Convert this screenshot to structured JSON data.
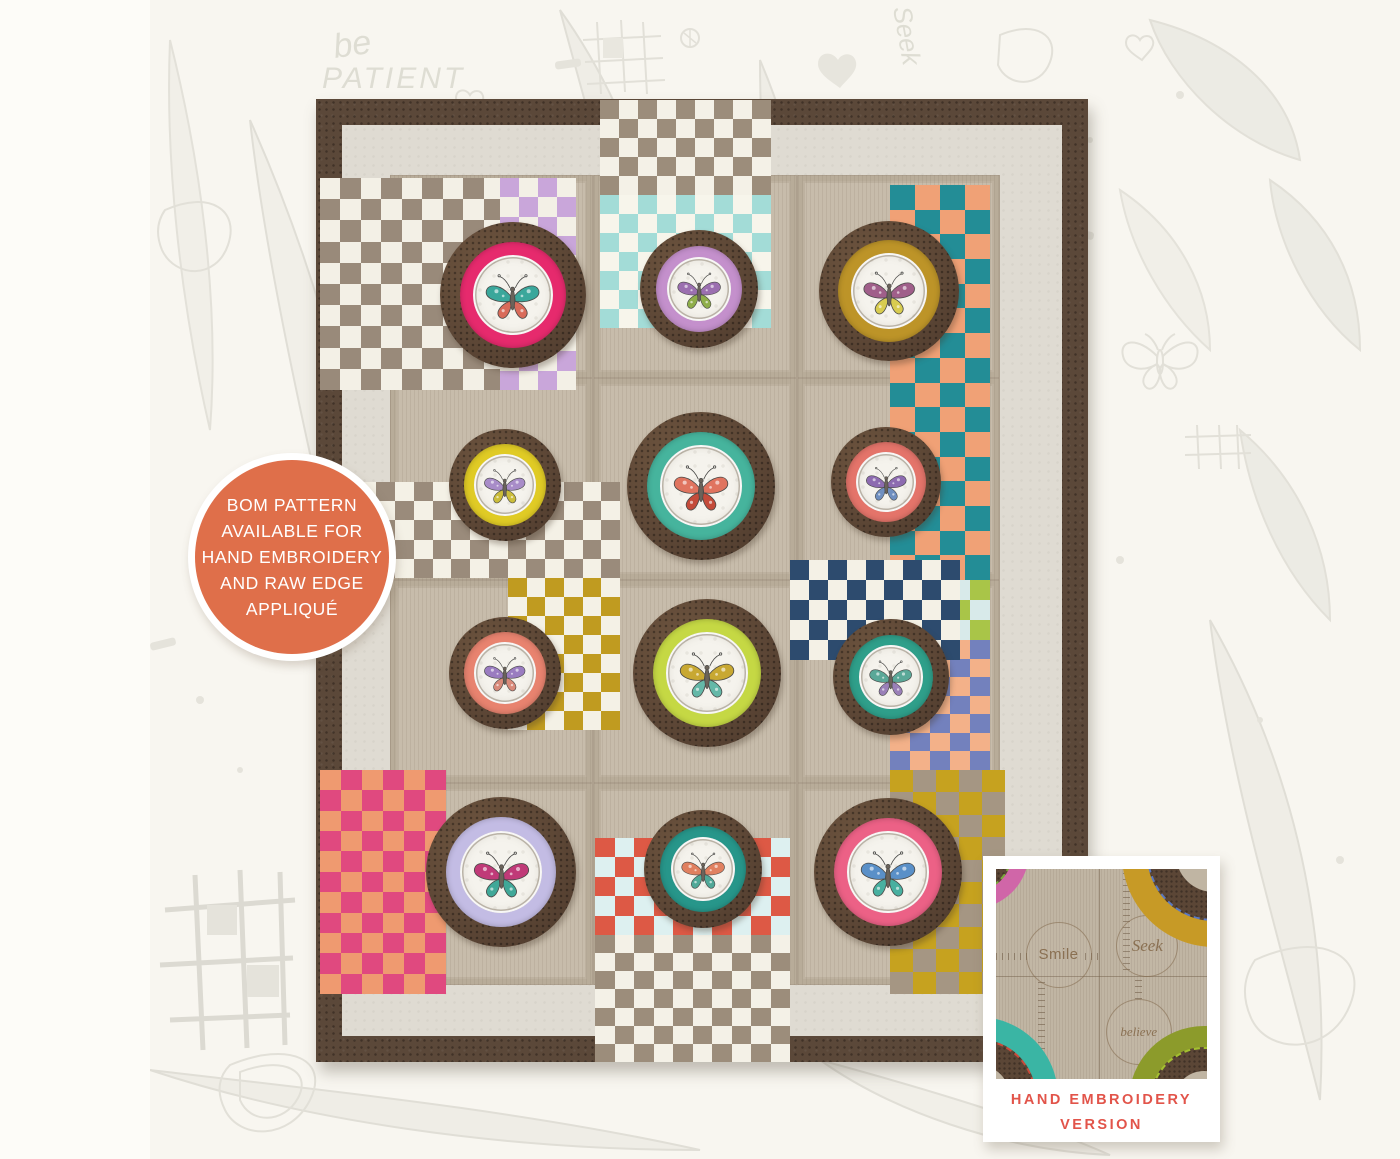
{
  "badge": {
    "lines": [
      "BOM PATTERN",
      "AVAILABLE FOR",
      "HAND EMBROIDERY",
      "AND RAW EDGE",
      "APPLIQUÉ"
    ],
    "bg_color": "#df6f4a",
    "text_color": "#ffffff"
  },
  "inset": {
    "caption_line1": "HAND EMBROIDERY",
    "caption_line2": "VERSION",
    "caption_color": "#e2544a",
    "words": [
      "Smile",
      "Seek",
      "believe"
    ],
    "fabric_color": "#c0b5a3",
    "corner_hoops": [
      {
        "pos": "top-left",
        "cx": -25,
        "cy": -18,
        "d": 115,
        "ring": "#d066a8",
        "stitch": "#7aa83a"
      },
      {
        "pos": "top-right",
        "cx": 218,
        "cy": -15,
        "d": 185,
        "ring": "#c79a26",
        "stitch": "#5a78c0"
      },
      {
        "pos": "bottom-left",
        "cx": -18,
        "cy": 228,
        "d": 160,
        "ring": "#3ab5a4",
        "stitch": "#c84a3a"
      },
      {
        "pos": "bottom-right",
        "cx": 208,
        "cy": 232,
        "d": 150,
        "ring": "#8c9b2b",
        "stitch": "#a4c030"
      }
    ]
  },
  "background_doodles": {
    "word_be": "be",
    "word_patient": "PATIENT",
    "word_seek": "Seek"
  },
  "quilt": {
    "origin": {
      "x": 316,
      "y": 99
    },
    "border_color": "#5b4839",
    "inner_border_color": "#dfdbd2",
    "field_color": "#c7bcab",
    "hoop_wood_color": "#5d4736",
    "hoops": [
      {
        "cx": 513,
        "cy": 295,
        "d": 146,
        "ring": "#e62a6d",
        "wing1": "#3aa79b",
        "wing2": "#d96b5a"
      },
      {
        "cx": 699,
        "cy": 289,
        "d": 118,
        "ring": "#c490cc",
        "wing1": "#9b6fb0",
        "wing2": "#8fae4a"
      },
      {
        "cx": 889,
        "cy": 291,
        "d": 140,
        "ring": "#bd9428",
        "wing1": "#a05f8a",
        "wing2": "#d8cc50"
      },
      {
        "cx": 505,
        "cy": 485,
        "d": 112,
        "ring": "#e0cb25",
        "wing1": "#a88cc8",
        "wing2": "#cbbd3a"
      },
      {
        "cx": 701,
        "cy": 486,
        "d": 148,
        "ring": "#46b49d",
        "wing1": "#e0745f",
        "wing2": "#c44b3a"
      },
      {
        "cx": 886,
        "cy": 482,
        "d": 110,
        "ring": "#e4746a",
        "wing1": "#8d6bb0",
        "wing2": "#6f8fc0"
      },
      {
        "cx": 505,
        "cy": 673,
        "d": 112,
        "ring": "#e8836f",
        "wing1": "#9a7cc0",
        "wing2": "#d98a7a"
      },
      {
        "cx": 707,
        "cy": 673,
        "d": 148,
        "ring": "#c5d844",
        "wing1": "#c8a832",
        "wing2": "#64b8a8"
      },
      {
        "cx": 891,
        "cy": 677,
        "d": 116,
        "ring": "#2f9f8a",
        "wing1": "#5aa898",
        "wing2": "#9a80b8"
      },
      {
        "cx": 501,
        "cy": 872,
        "d": 150,
        "ring": "#c3bce4",
        "wing1": "#c03a78",
        "wing2": "#40a898"
      },
      {
        "cx": 703,
        "cy": 869,
        "d": 118,
        "ring": "#27968a",
        "wing1": "#e08060",
        "wing2": "#50a898"
      },
      {
        "cx": 888,
        "cy": 872,
        "d": 148,
        "ring": "#ec6186",
        "wing1": "#5a90c8",
        "wing2": "#48b0a0"
      }
    ],
    "checkerboards": [
      {
        "x": 320,
        "y": 178,
        "w": 184,
        "h": 212,
        "cell": 21,
        "c1": "#f3f0e6",
        "c2": "#998a7a"
      },
      {
        "x": 500,
        "y": 178,
        "w": 76,
        "h": 212,
        "cell": 19,
        "c1": "#c9a6da",
        "c2": "#f3f0e6"
      },
      {
        "x": 600,
        "y": 100,
        "w": 171,
        "h": 95,
        "cell": 19,
        "c1": "#9c8d7b",
        "c2": "#f4f1e7"
      },
      {
        "x": 600,
        "y": 195,
        "w": 171,
        "h": 133,
        "cell": 19,
        "c1": "#a3dcd7",
        "c2": "#f7f5eb"
      },
      {
        "x": 890,
        "y": 185,
        "w": 100,
        "h": 395,
        "cell": 25,
        "c1": "#238d96",
        "c2": "#f0a176"
      },
      {
        "x": 890,
        "y": 580,
        "w": 100,
        "h": 60,
        "cell": 20,
        "c1": "#a9c548",
        "c2": "#d8eaea"
      },
      {
        "x": 890,
        "y": 640,
        "w": 100,
        "h": 130,
        "cell": 20,
        "c1": "#7381bd",
        "c2": "#f3b189"
      },
      {
        "x": 320,
        "y": 482,
        "w": 300,
        "h": 96,
        "cell": 19,
        "c1": "#f4f1e6",
        "c2": "#9a8b7b"
      },
      {
        "x": 508,
        "y": 578,
        "w": 112,
        "h": 152,
        "cell": 19,
        "c1": "#c09b20",
        "c2": "#f4f1e6"
      },
      {
        "x": 790,
        "y": 560,
        "w": 170,
        "h": 100,
        "cell": 19,
        "c1": "#2d4b6e",
        "c2": "#f4f1e6"
      },
      {
        "x": 320,
        "y": 770,
        "w": 126,
        "h": 224,
        "cell": 21,
        "c1": "#ef9a70",
        "c2": "#e0497f"
      },
      {
        "x": 595,
        "y": 838,
        "w": 195,
        "h": 97,
        "cell": 19,
        "c1": "#dd5945",
        "c2": "#ddf0f0"
      },
      {
        "x": 595,
        "y": 935,
        "w": 195,
        "h": 127,
        "cell": 19,
        "c1": "#9c8d7b",
        "c2": "#f4f1e7"
      },
      {
        "x": 890,
        "y": 770,
        "w": 115,
        "h": 224,
        "cell": 23,
        "c1": "#c6a21f",
        "c2": "#a59683"
      }
    ]
  }
}
